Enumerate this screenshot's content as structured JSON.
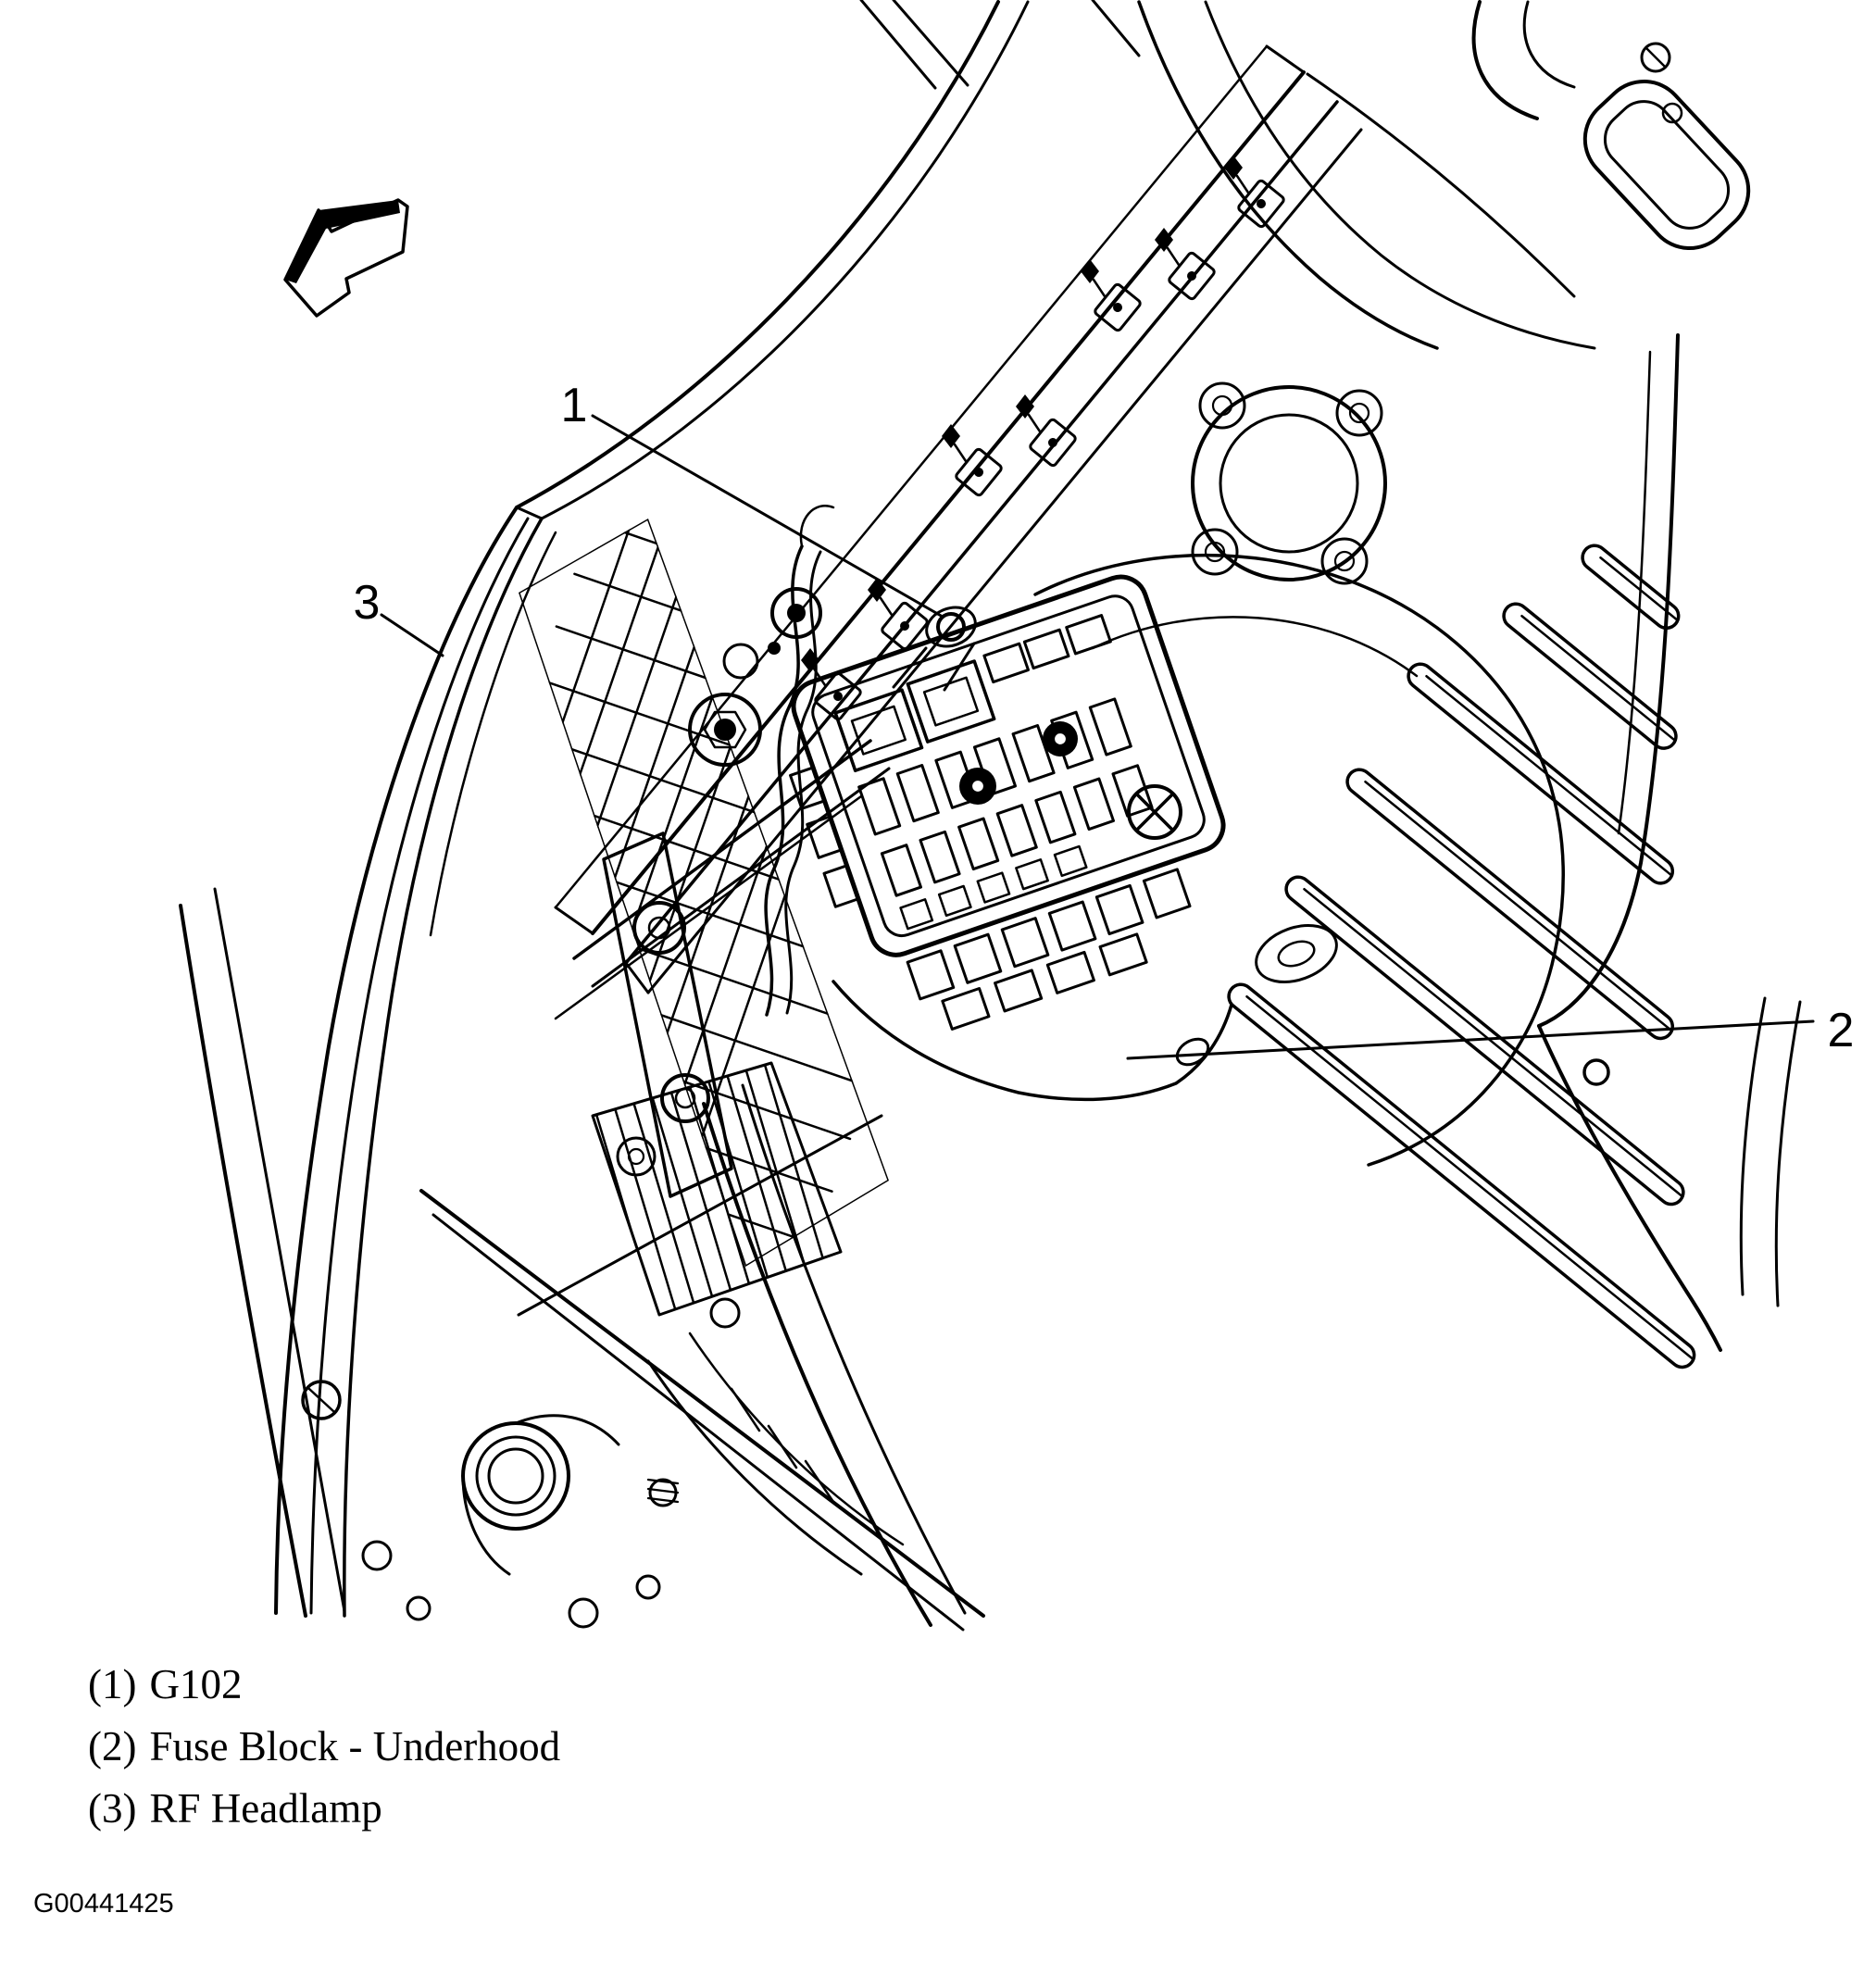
{
  "document": {
    "kind": "engine-compartment line illustration",
    "background_color": "#ffffff",
    "ink_color": "#000000"
  },
  "callouts": [
    {
      "number": "1"
    },
    {
      "number": "2"
    },
    {
      "number": "3"
    }
  ],
  "legend": {
    "items": [
      {
        "marker": "(1)",
        "label": "G102"
      },
      {
        "marker": "(2)",
        "label": "Fuse Block - Underhood"
      },
      {
        "marker": "(3)",
        "label": "RF Headlamp"
      }
    ]
  },
  "figure_code": "G00441425"
}
